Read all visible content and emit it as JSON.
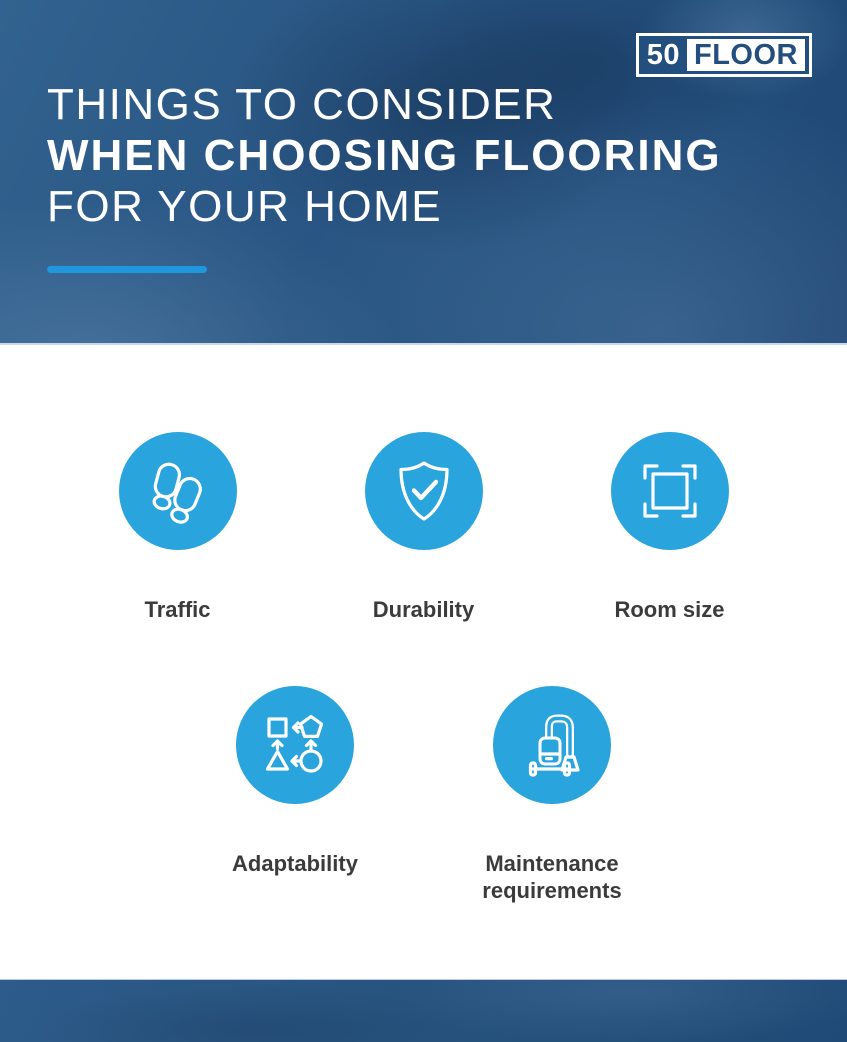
{
  "header": {
    "logo": {
      "number": "50",
      "word": "FLOOR"
    },
    "title": {
      "line1": "THINGS TO CONSIDER",
      "line2": "WHEN CHOOSING FLOORING",
      "line3": "FOR YOUR HOME"
    }
  },
  "items": [
    {
      "label": "Traffic",
      "icon": "footprints-icon"
    },
    {
      "label": "Durability",
      "icon": "shield-check-icon"
    },
    {
      "label": "Room size",
      "icon": "room-size-icon"
    },
    {
      "label": "Adaptability",
      "icon": "adaptability-shapes-icon"
    },
    {
      "label": "Maintenance requirements",
      "icon": "vacuum-cleaner-icon"
    }
  ],
  "colors": {
    "circle-blue": "#2aa4dc",
    "accent-blue": "#2097dd",
    "logo-navy": "#234f7e",
    "hero-blue": "#27547f",
    "footer-blue": "#27547f",
    "label-gray": "#3b3b3b"
  }
}
